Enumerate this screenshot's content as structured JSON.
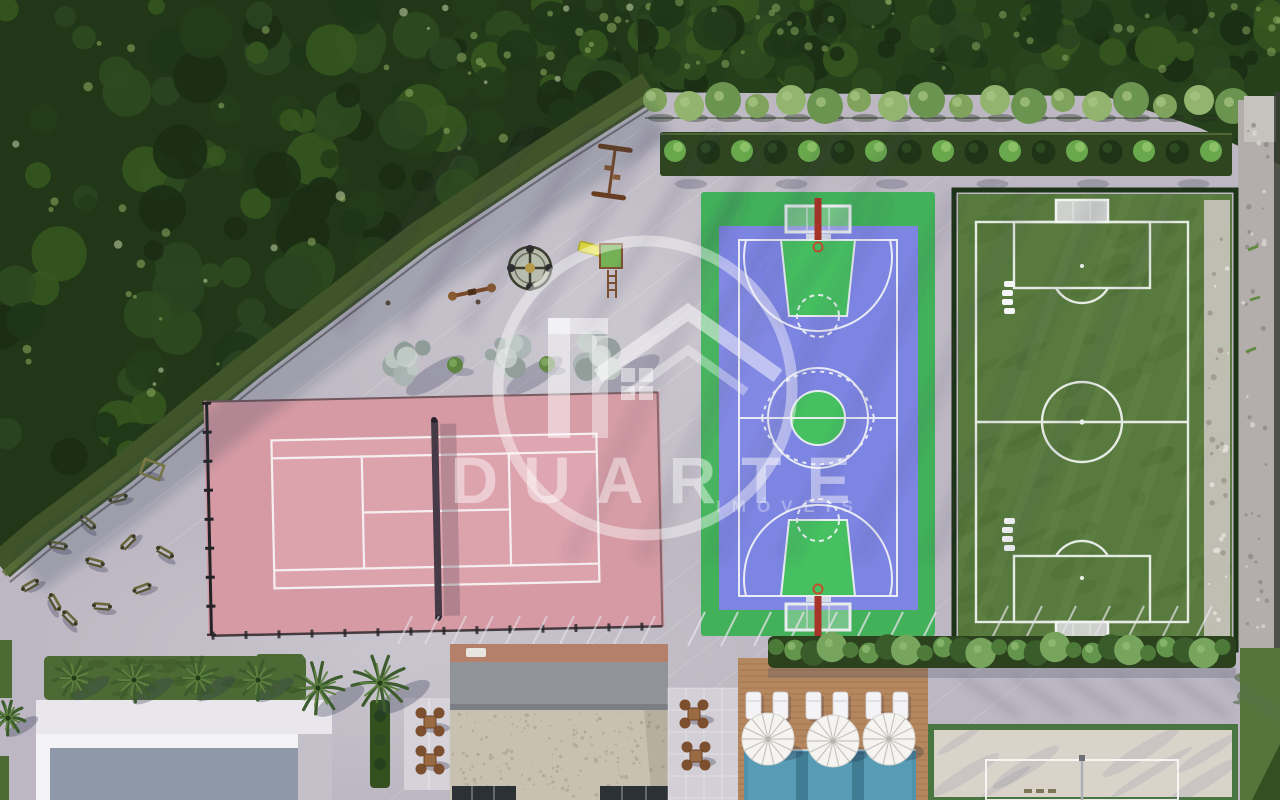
{
  "image_type": "aerial-3d-render",
  "watermark": {
    "brand": "DUARTE",
    "subtitle": "IMÓVEIS",
    "logo": "duarte-house-logo"
  },
  "areas": [
    "forest",
    "hedgerow",
    "planter-strip",
    "playground",
    "outdoor-gym",
    "paved-plaza",
    "tennis-court",
    "multisport-court",
    "soccer-field",
    "beach-volleyball-court",
    "swimming-pool",
    "pool-deck",
    "sun-loungers",
    "umbrellas",
    "clubhouse-buildings",
    "palm-trees",
    "lawns",
    "gravel-path"
  ],
  "palette": {
    "pavement": "#bcb7c2",
    "forest_green": "#223618",
    "tennis_pink": "#d59aa3",
    "court_blue": "#7d85e3",
    "court_green": "#42b15a",
    "field_green": "#587a3e",
    "pool_blue": "#4f92ac",
    "sand": "#d9d3ca",
    "deck_wood": "#b5875f",
    "hedge_green": "#2c421e",
    "watermark_white": "#ffffff"
  }
}
